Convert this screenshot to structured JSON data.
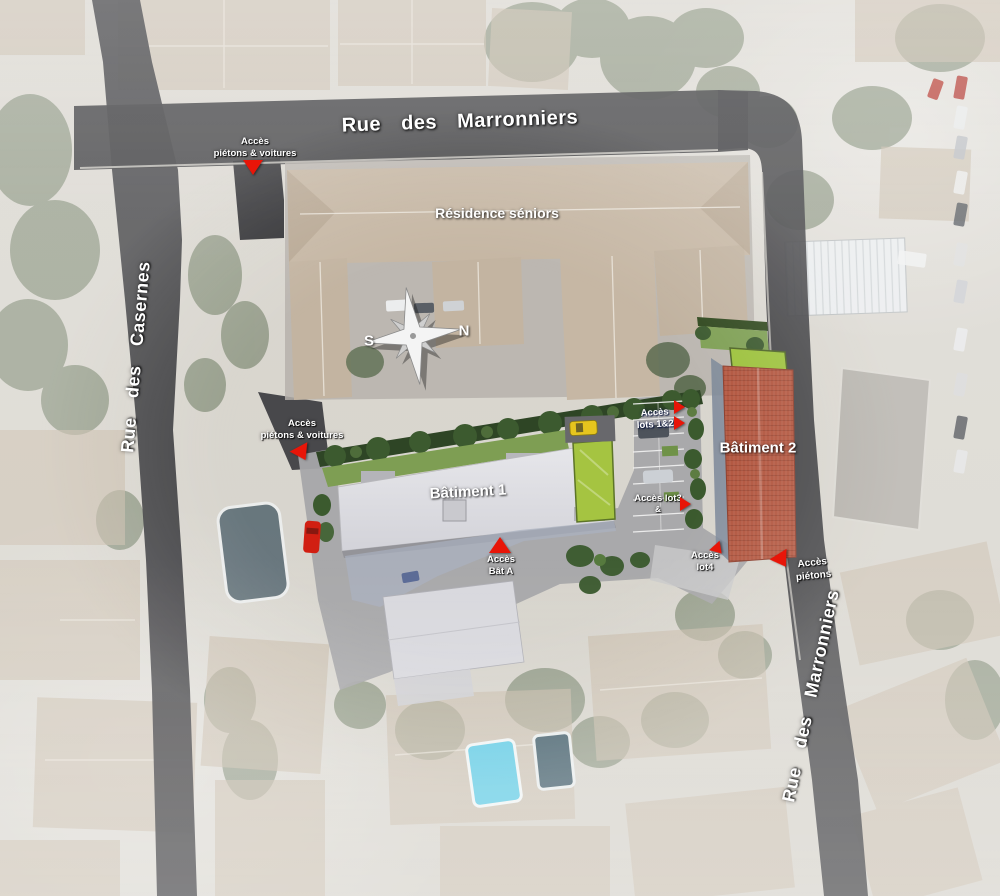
{
  "map": {
    "streets": {
      "marronniers_top": "Rue des Marronniers",
      "casernes": "Rue des Casernes",
      "marronniers_east": "Rue des Marronniers"
    },
    "buildings": {
      "residence": "Résidence séniors",
      "batiment1": "Bâtiment 1",
      "batiment2": "Bâtiment 2"
    },
    "access": {
      "north_entrance": {
        "line1": "Accès",
        "line2": "piétons & voitures"
      },
      "west_entrance": {
        "line1": "Accès",
        "line2": "piétons & voitures"
      },
      "bat_a": {
        "line1": "Accès",
        "line2": "Bât A"
      },
      "lots_1_2": {
        "line1": "Accès",
        "line2": "lots 1&2"
      },
      "lot_3": {
        "line1": "Accès lot3",
        "line2": "&"
      },
      "lot_4": {
        "line1": "Accès",
        "line2": "lot4"
      },
      "pietons_east": {
        "line1": "Accès",
        "line2": "piétons"
      }
    },
    "compass": {
      "south": "S",
      "north": "N"
    },
    "colors": {
      "road": "#3a3a3d",
      "accent_red": "#e81508",
      "label_text": "#ffffff",
      "batiment1_roof": "#dfdfe3",
      "batiment2_roof": "#b2553e",
      "green_roof": "#9dc23d",
      "residence_roof": "#c6b7a4"
    }
  }
}
